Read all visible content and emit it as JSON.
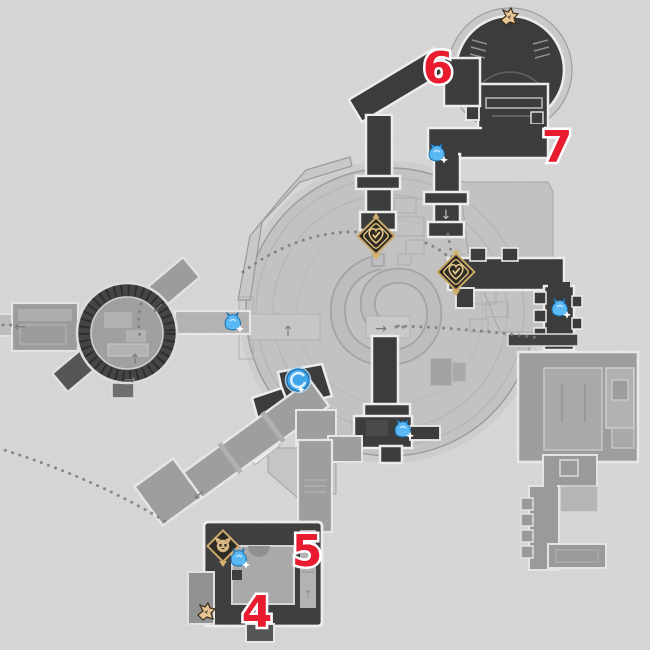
{
  "map": {
    "name": "game-area-map",
    "route_numbers": [
      {
        "label": "6"
      },
      {
        "label": "7"
      },
      {
        "label": "5"
      },
      {
        "label": "4"
      }
    ],
    "arrows": [
      {
        "name": "west-corridor-arrow",
        "glyph": "←"
      },
      {
        "name": "ring-up-arrow",
        "glyph": "↑"
      },
      {
        "name": "ring-descend-arrow",
        "glyph": "↙"
      },
      {
        "name": "ring-exit-arrow",
        "glyph": "→"
      },
      {
        "name": "plaza-entrance-arrow",
        "glyph": "↑"
      },
      {
        "name": "plaza-exit-arrow",
        "glyph": "→"
      },
      {
        "name": "north-corridor-down-arrow",
        "glyph": "↓"
      },
      {
        "name": "southwest-corridor-arrow",
        "glyph": "↙"
      },
      {
        "name": "storage-strip-arrow",
        "glyph": "↑"
      }
    ],
    "icons": [
      {
        "name": "space-anchor-icon",
        "count": 2
      },
      {
        "name": "enemy-icon",
        "count": 5
      },
      {
        "name": "elite-enemy-icon",
        "count": 1
      },
      {
        "name": "warp-trotter-icon",
        "count": 1
      },
      {
        "name": "origami-bird-collectible-icon",
        "count": 2
      }
    ],
    "colors": {
      "background": "#d6d6d6",
      "plaza": "#c2c2c2",
      "room_medium": "#9d9d9d",
      "room_dark": "#3c3c3c",
      "white_outline": "#ececec",
      "route_dots": "#7a7a7a",
      "number_red": "#e81b2f",
      "anchor_gold": "#d4b26e",
      "enemy_blue": "#57b7f4",
      "collectible_tan": "#e6c495"
    }
  }
}
